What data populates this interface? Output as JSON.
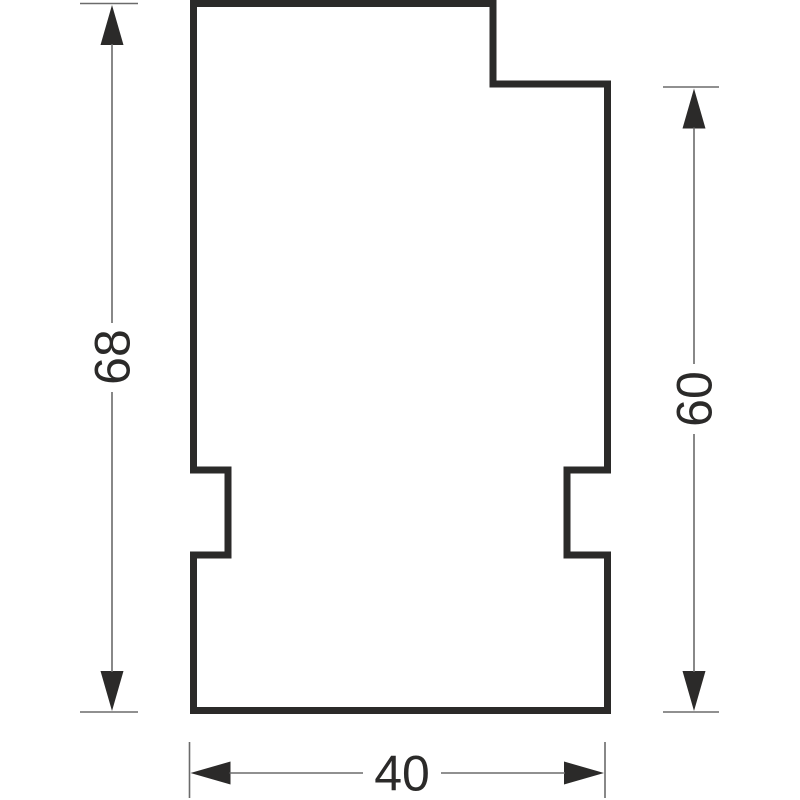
{
  "drawing": {
    "type": "dimensioned-part-outline",
    "dimensions": {
      "left": {
        "label": "68",
        "orientation": "vertical",
        "text_rotation_deg": -90
      },
      "right": {
        "label": "60",
        "orientation": "vertical",
        "text_rotation_deg": -90
      },
      "bottom": {
        "label": "40",
        "orientation": "horizontal",
        "text_rotation_deg": 0
      }
    }
  },
  "colors": {
    "outline": "#2b2a29",
    "thin_line": "#6b6b6b",
    "text": "#2b2a29",
    "background": "#ffffff"
  }
}
